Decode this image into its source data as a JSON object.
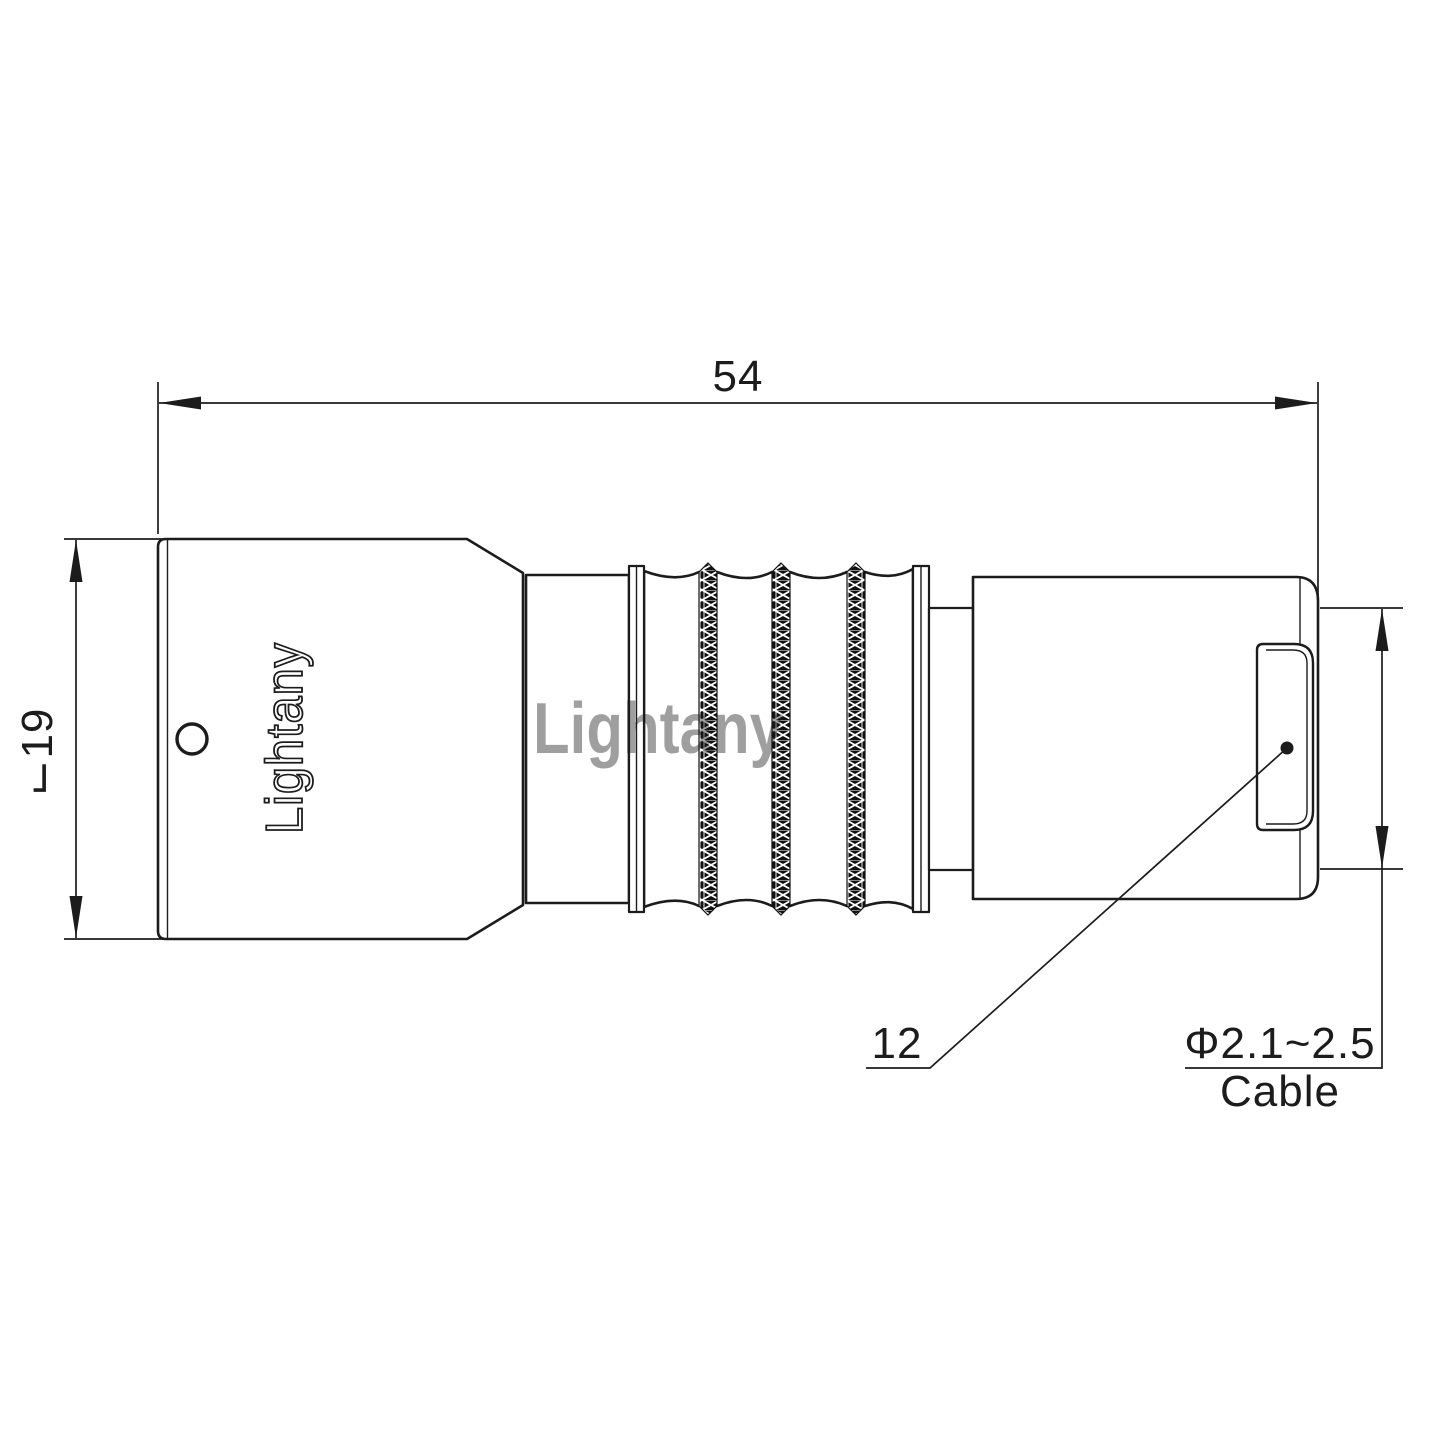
{
  "drawing": {
    "background": "#ffffff",
    "line_color": "#1c1c1c",
    "watermark_color": "#dd9494",
    "labels": {
      "total_length": "54",
      "body_diameter": "⌙19",
      "part_ref": "12",
      "cable_diameter_range": "Φ2.1~2.5",
      "cable_word": "Cable"
    },
    "branding": {
      "engraving": "Lightany",
      "watermark": "Lightany"
    }
  }
}
